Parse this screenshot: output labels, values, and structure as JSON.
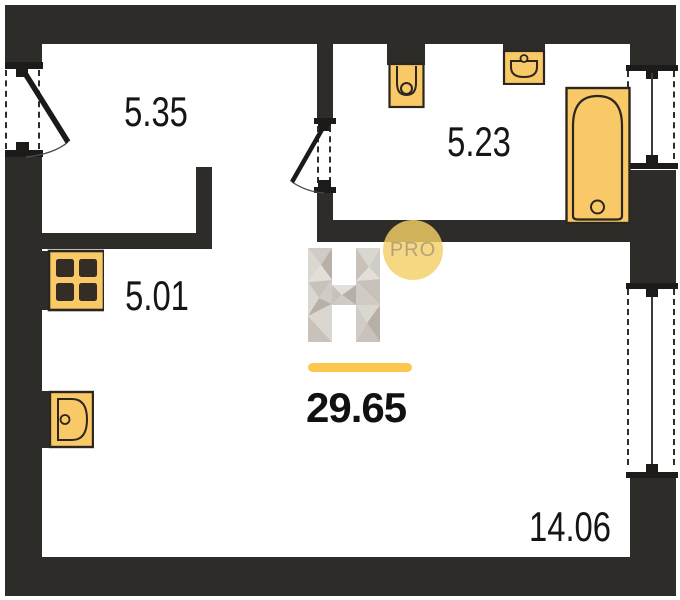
{
  "floor_plan": {
    "total_area": "29.65",
    "badge_label": "PRO",
    "logo_letter": "H",
    "rooms": [
      {
        "id": "hallway",
        "area": "5.35"
      },
      {
        "id": "bathroom",
        "area": "5.23"
      },
      {
        "id": "kitchen",
        "area": "5.01"
      },
      {
        "id": "living-room",
        "area": "14.06"
      }
    ],
    "colors": {
      "walls": "#2e2c29",
      "fixture_fill": "#f9c967",
      "fixture_stroke": "#2b2620",
      "accent_bar": "#fcc64f",
      "badge_fill": "#f3d066",
      "badge_text": "#b3a27c",
      "label_text": "#151515",
      "background": "#ffffff"
    },
    "fixtures": [
      "entrance-door",
      "bathroom-door",
      "toilet",
      "washbasin",
      "bathtub",
      "stove",
      "kitchen-sink",
      "window-bathroom",
      "window-living-room"
    ]
  }
}
